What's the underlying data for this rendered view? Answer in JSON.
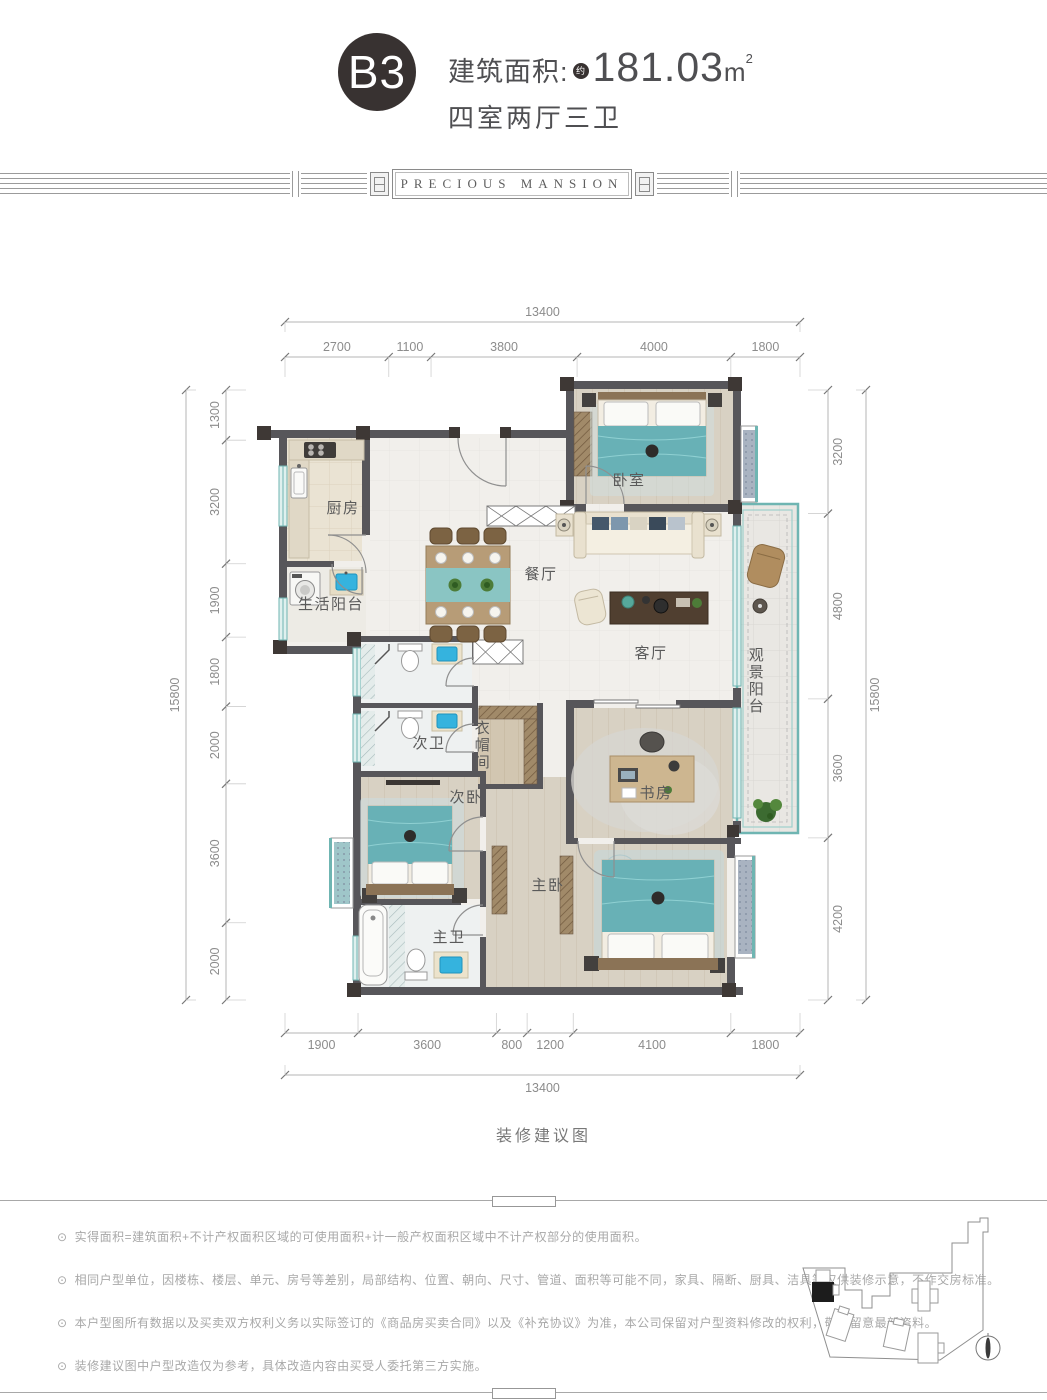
{
  "header": {
    "unit": "B3",
    "area_label": "建筑面积:",
    "area_approx": "约",
    "area_value": "181.03",
    "area_unit": "m",
    "area_sup": "2",
    "layout_text": "四室两厅三卫"
  },
  "brand_band": {
    "text": "PRECIOUS MANSION"
  },
  "plan": {
    "caption": "装修建议图",
    "dims": {
      "top_total": 13400,
      "top_segments": [
        2700,
        1100,
        3800,
        4000,
        1800
      ],
      "bottom_segments": [
        1900,
        3600,
        800,
        1200,
        4100,
        1800
      ],
      "bottom_total": 13400,
      "left_total": 15800,
      "left_segments": [
        1300,
        3200,
        1900,
        1800,
        2000,
        3600,
        2000
      ],
      "right_segments": [
        3200,
        4800,
        3600,
        4200
      ],
      "right_total": 15800
    },
    "rooms": [
      {
        "id": "kitchen",
        "label": "厨房"
      },
      {
        "id": "service-balcony",
        "label": "生活阳台"
      },
      {
        "id": "dining",
        "label": "餐厅"
      },
      {
        "id": "bedroom",
        "label": "卧室"
      },
      {
        "id": "living",
        "label": "客厅"
      },
      {
        "id": "view-balcony",
        "label": "观景阳台",
        "vertical": true
      },
      {
        "id": "second-bath",
        "label": "次卫"
      },
      {
        "id": "cloakroom",
        "label": "衣帽间",
        "vertical": true
      },
      {
        "id": "second-bedroom",
        "label": "次卧"
      },
      {
        "id": "study",
        "label": "书房"
      },
      {
        "id": "master-bedroom",
        "label": "主卧"
      },
      {
        "id": "master-bath",
        "label": "主卫"
      }
    ]
  },
  "note_bullet": "⊙",
  "notes": [
    "实得面积=建筑面积+不计产权面积区域的可使用面积+计一般产权面积区域中不计产权部分的使用面积。",
    "相同户型单位，因楼栋、楼层、单元、房号等差别，局部结构、位置、朝向、尺寸、管道、面积等可能不同，家具、隔断、厨具、洁具等仅供装修示意，不作交房标准。",
    "本户型图所有数据以及买卖双方权利义务以实际签订的《商品房买卖合同》以及《补充协议》为准，本公司保留对户型资料修改的权利，敬请留意最新资料。",
    "装修建议图中户型改造仅为参考，具体改造内容由买受人委托第三方实施。"
  ],
  "colors": {
    "badge": "#383231",
    "wall": "#57565a",
    "wall_corner": "#3e3835",
    "accent_teal": "#6fb5b2",
    "bed_teal": "#68b1b6",
    "wood_floor": "#d8d1c3",
    "sink_blue": "#35b3de",
    "dim_text": "#8c8c8c"
  }
}
